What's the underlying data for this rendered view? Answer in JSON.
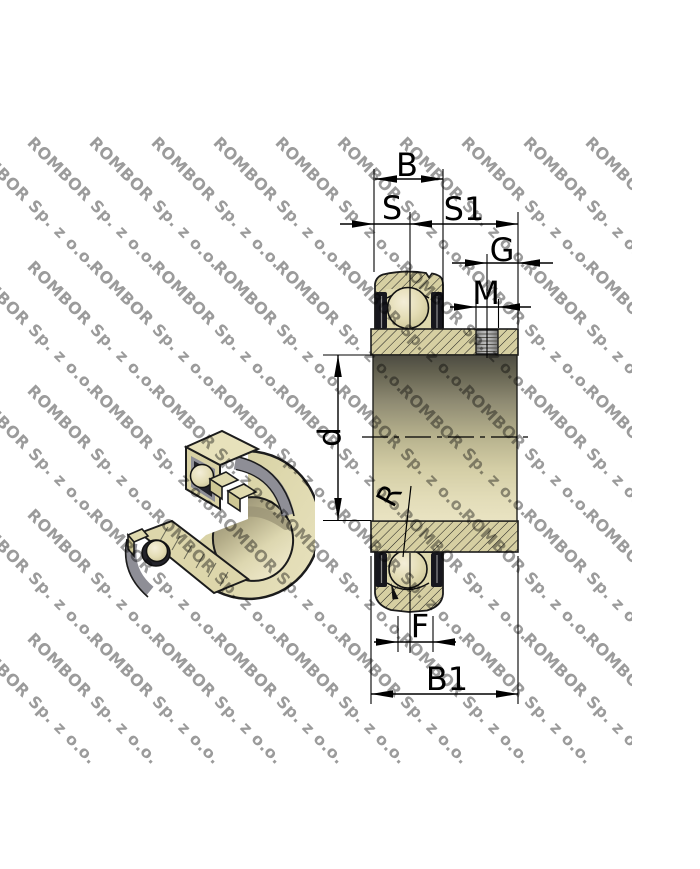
{
  "watermark": {
    "text": "ROMBOR Sp. z o.o."
  },
  "drawing": {
    "kind": "insert-ball-bearing technical drawing",
    "views": [
      "3d-cutaway-render",
      "dimensioned-cross-section"
    ],
    "labels": {
      "B": "B",
      "S": "S",
      "S1": "S1",
      "G": "G",
      "M": "M",
      "d": "d",
      "R": "R",
      "F": "F",
      "B1": "B1"
    }
  },
  "colors": {
    "brass": "#d6cfa2",
    "brass_light": "#ded8ad",
    "steel_gray": "#8e8e96",
    "seal_dark": "#17171d",
    "outline": "#1b1b1b",
    "dim_line": "#000000",
    "watermark_gray": "#9b9b9b",
    "background": "#ffffff"
  }
}
